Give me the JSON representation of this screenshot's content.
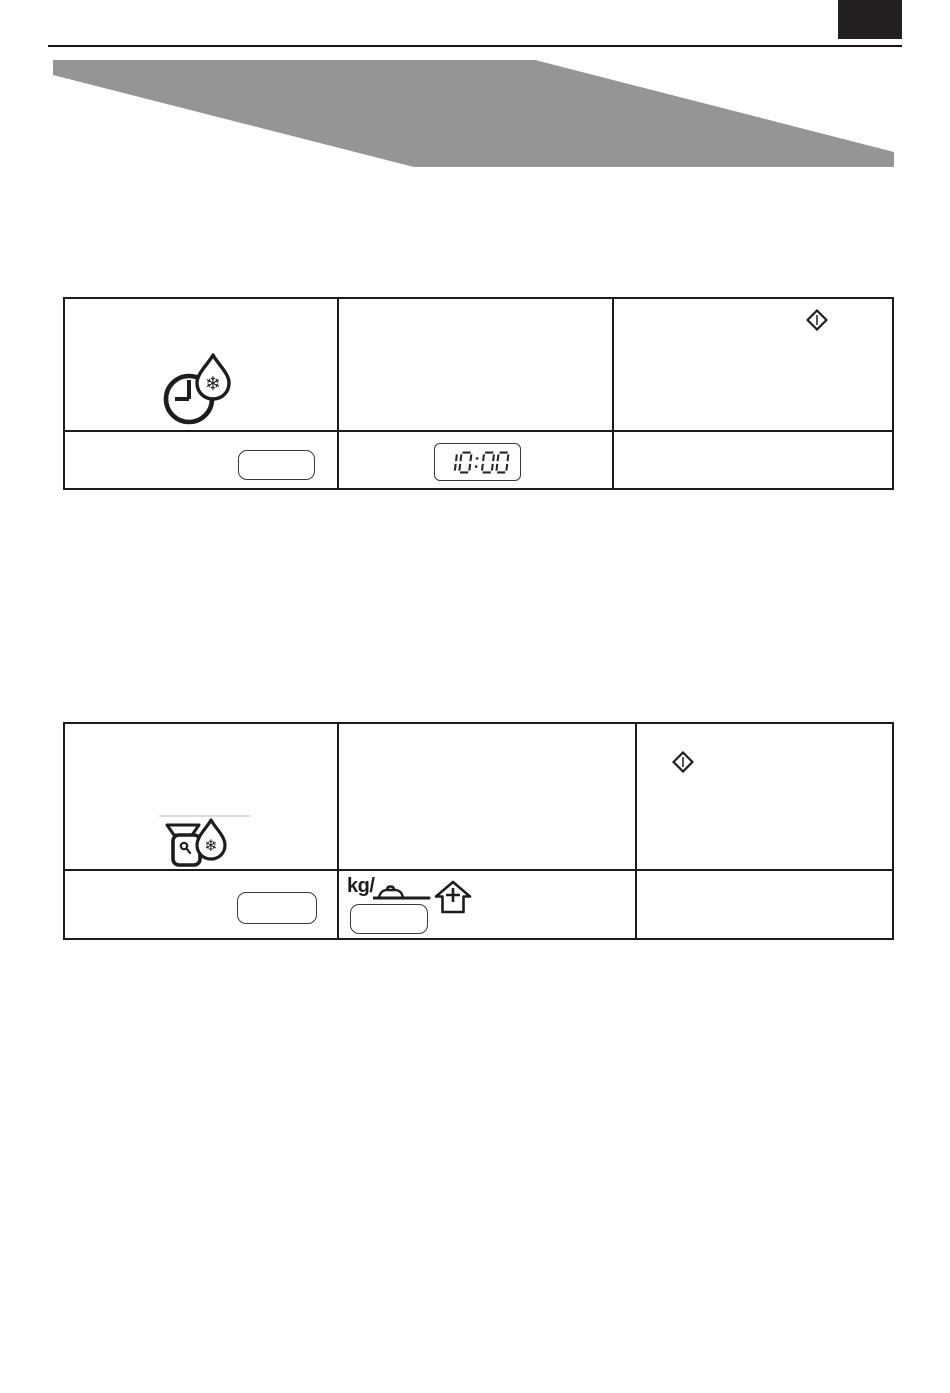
{
  "document": {
    "kind": "appliance-manual-page",
    "background": "#ffffff"
  },
  "header": {
    "corner_tab_color": "#231f20",
    "rule_color": "#161616",
    "banner_color": "#959595"
  },
  "table_time_defrost": {
    "row_icons": {
      "c1": "time-defrost-icon",
      "c3": "start-diamond-icon"
    },
    "row_controls": {
      "c1_button_label": "",
      "c2_display_value": "10:00"
    }
  },
  "table_weight_defrost": {
    "row_icons": {
      "c1": "weight-defrost-icon",
      "c3": "start-diamond-icon"
    },
    "row_controls": {
      "c1_button_label": "",
      "c2_label": "kg/",
      "c2_icons": [
        "dish-icon",
        "up-plus-arrow-icon"
      ],
      "c2_button_label": ""
    }
  },
  "colors": {
    "table_border": "#1c1c1c",
    "icon_ink": "#1d1d1d",
    "display_ink": "#262626",
    "faint_divider": "#dcdcdc"
  }
}
